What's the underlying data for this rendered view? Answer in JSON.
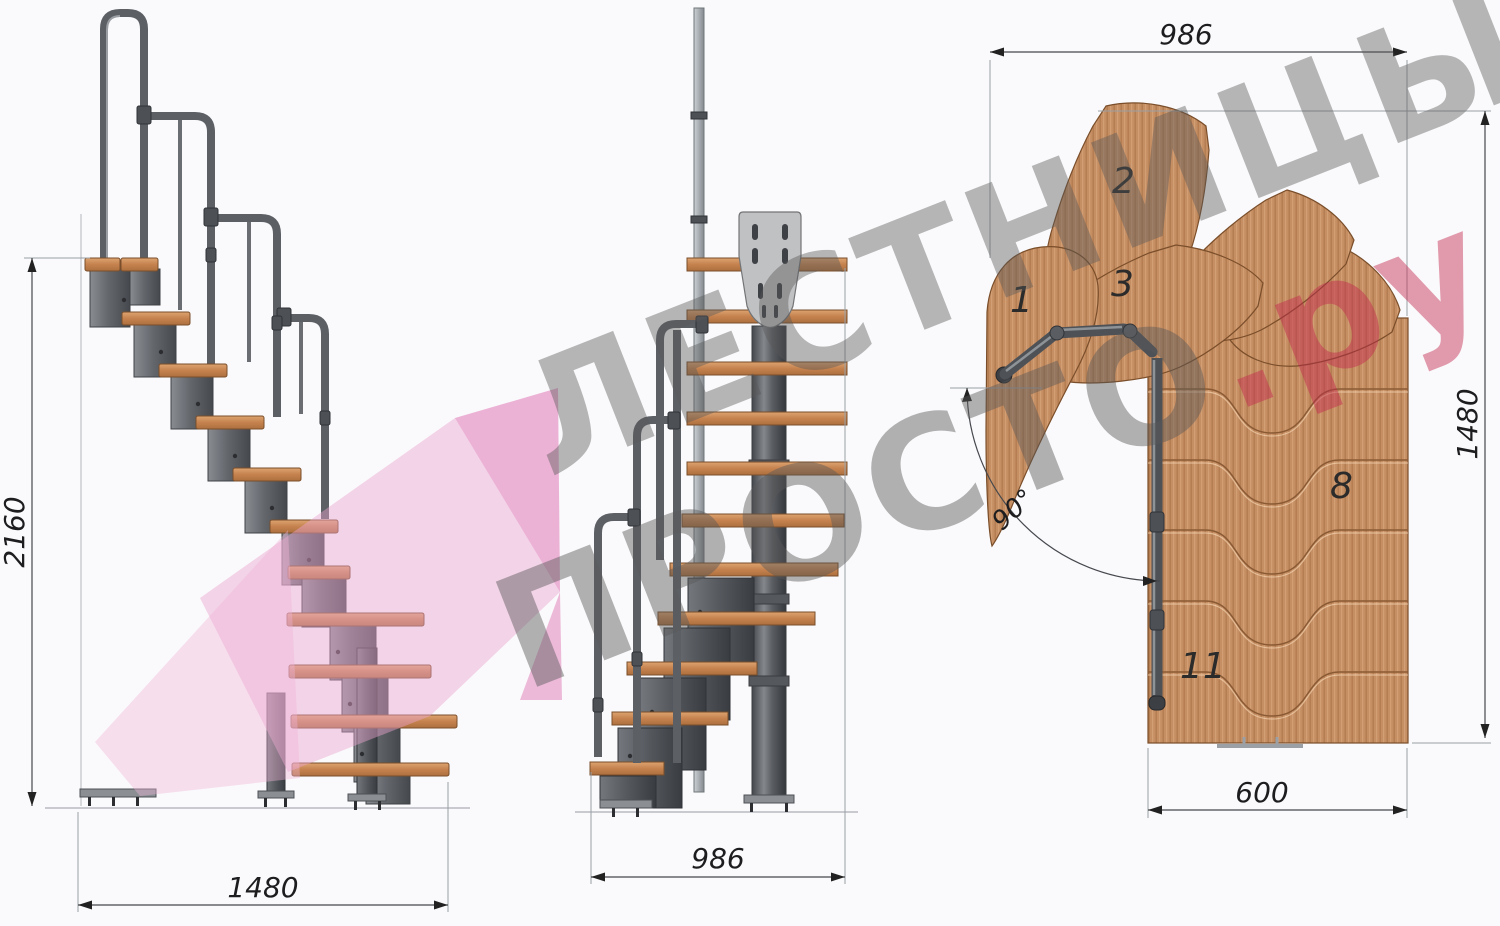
{
  "watermark": {
    "line1": "ЛЕСТНИЦЫ",
    "line2": "ПРОСТО",
    "line2_suffix": ".ру",
    "gray_color": "#585858",
    "red_color": "#c2274d",
    "pink_color": "#eca3cf"
  },
  "side_view": {
    "height_dim": "2160",
    "width_dim": "1480"
  },
  "front_view": {
    "width_dim": "986"
  },
  "plan_view": {
    "top_dim": "986",
    "right_dim": "1480",
    "bottom_dim": "600",
    "angle_label": "90°",
    "steps": {
      "s1": "1",
      "s2": "2",
      "s3": "3",
      "s8": "8",
      "s11": "11"
    }
  },
  "colors": {
    "background": "#fafafc",
    "wood": "#c68e63",
    "metal": "#5c6065"
  }
}
